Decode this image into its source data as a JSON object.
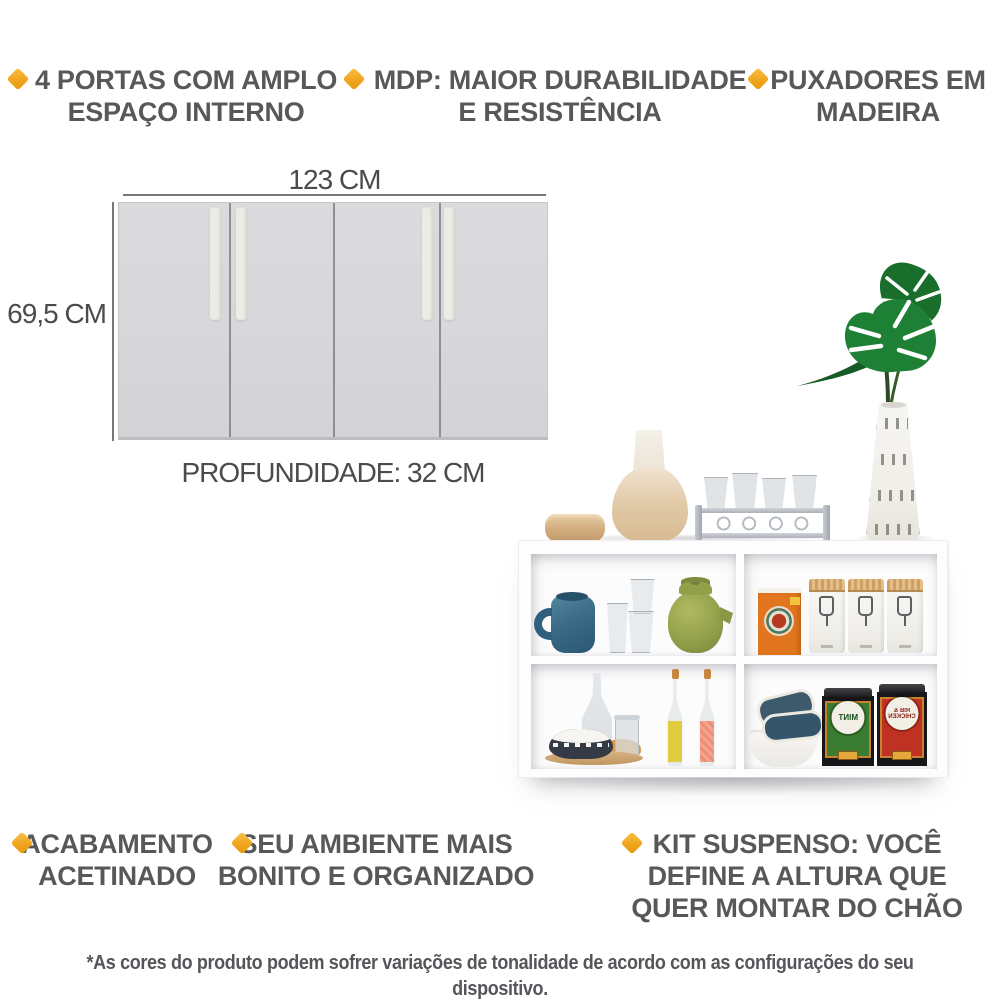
{
  "features_top": [
    {
      "lines": [
        "4 PORTAS COM AMPLO",
        "ESPAÇO INTERNO"
      ]
    },
    {
      "lines": [
        "MDP: MAIOR DURABILIDADE",
        "E RESISTÊNCIA"
      ]
    },
    {
      "lines": [
        "PUXADORES EM",
        "MADEIRA"
      ]
    }
  ],
  "features_bottom": [
    {
      "lines": [
        "ACABAMENTO",
        "ACETINADO"
      ]
    },
    {
      "lines": [
        "SEU AMBIENTE MAIS",
        "BONITO E ORGANIZADO"
      ]
    },
    {
      "lines": [
        "KIT SUSPENSO: VOCÊ",
        "DEFINE A ALTURA QUE",
        "QUER MONTAR DO CHÃO"
      ]
    }
  ],
  "diagram": {
    "width_label": "123 CM",
    "height_label": "69,5 CM",
    "depth_label": "PROFUNDIDADE: 32 CM"
  },
  "photo": {
    "tins": [
      {
        "label": "MINT"
      },
      {
        "label": "RIB & CHICKEN"
      }
    ]
  },
  "footer": {
    "disclaimer": "*As cores do produto podem sofrer variações de tonalidade de acordo com as configurações do seu dispositivo."
  },
  "colors": {
    "accent": "#F0A51D",
    "feature_text": "#58585A",
    "dimension_text": "#4B4B4F"
  }
}
